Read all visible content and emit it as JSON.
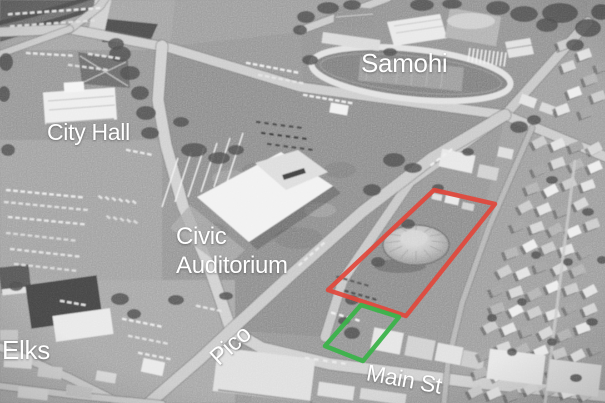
{
  "annotations": {
    "labels": {
      "samohi": "Samohi",
      "city_hall": "City Hall",
      "civic_auditorium_line1": "Civic",
      "civic_auditorium_line2": "Auditorium",
      "elks": "Elks",
      "pico_street": "Pico",
      "main_street": "Main St"
    },
    "label_color": "#ffffff",
    "red_outline_color": "#e2473b",
    "green_outline_color": "#3bb34a"
  }
}
